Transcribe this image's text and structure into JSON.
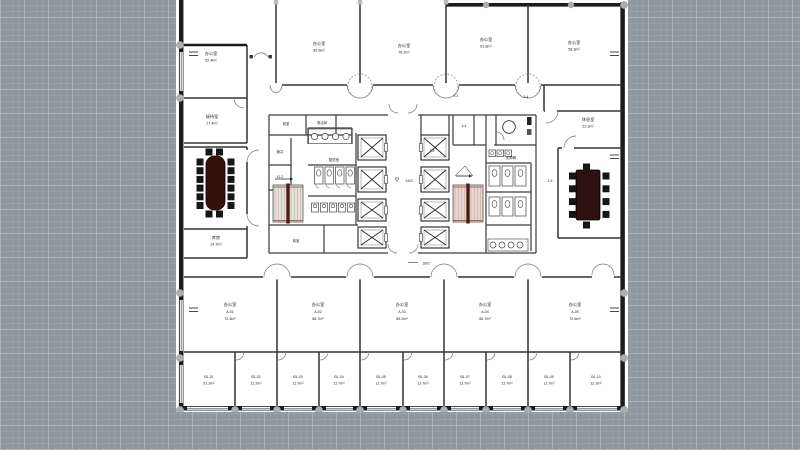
{
  "app": {
    "type": "cad-canvas",
    "content": "architectural floor plan"
  },
  "colors": {
    "canvas_bg": "#8e979d",
    "grid_minor": "#98a1a7",
    "grid_major": "#aab3b8",
    "paper": "#ffffff",
    "wall": "#1c1c1c",
    "table": "#36120d",
    "chair": "#161616",
    "stair_rail": "#4a1c12",
    "stair_left_fill": "#e6e2da",
    "stair_right_fill": "#e9d6d0",
    "column_dot": "#a9b0b4"
  },
  "rooms": {
    "top": [
      {
        "name": "办公室",
        "area": "52.4m²"
      },
      {
        "name": "办公室",
        "area": "82.6m²"
      },
      {
        "name": "办公室",
        "area": "76.2m²"
      },
      {
        "name": "办公室",
        "area": "61.8m²"
      },
      {
        "name": "办公室",
        "area": "58.3m²"
      }
    ],
    "mid_left": {
      "name": "接待室",
      "area": "27.4m²"
    },
    "mid_right": {
      "name": "休息室",
      "area": "22.3m²"
    },
    "store": {
      "name": "库房",
      "area": "14.7m²"
    },
    "offices": [
      {
        "name": "办公室",
        "code": "A-01",
        "area": "72.3m²"
      },
      {
        "name": "办公室",
        "code": "A-02",
        "area": "66.7m²"
      },
      {
        "name": "办公室",
        "code": "A-03",
        "area": "65.2m²"
      },
      {
        "name": "办公室",
        "code": "A-04",
        "area": "66.7m²"
      },
      {
        "name": "办公室",
        "code": "A-05",
        "area": "72.6m²"
      }
    ],
    "cells": [
      {
        "code": "B1-01",
        "area": "51.3m²"
      },
      {
        "code": "B1-02",
        "area": "11.2m²"
      },
      {
        "code": "B1-03",
        "area": "11.7m²"
      },
      {
        "code": "B1-04",
        "area": "11.7m²"
      },
      {
        "code": "B1-05",
        "area": "11.7m²"
      },
      {
        "code": "B1-06",
        "area": "11.7m²"
      },
      {
        "code": "B1-07",
        "area": "11.7m²"
      },
      {
        "code": "B1-08",
        "area": "11.7m²"
      },
      {
        "code": "B1-09",
        "area": "11.7m²"
      },
      {
        "code": "B1-10",
        "area": "12.3m²"
      }
    ]
  },
  "annotations": {
    "lobby_dim": "1402",
    "corridor_dim": "1602",
    "note_right": "1.5",
    "note_top": "4.2",
    "note_top2": "3-4",
    "core": [
      "前室",
      "清洁间",
      "管井",
      "11.2",
      "盥洗室",
      "前室",
      "2.8",
      "4.4",
      "无障碍"
    ]
  }
}
